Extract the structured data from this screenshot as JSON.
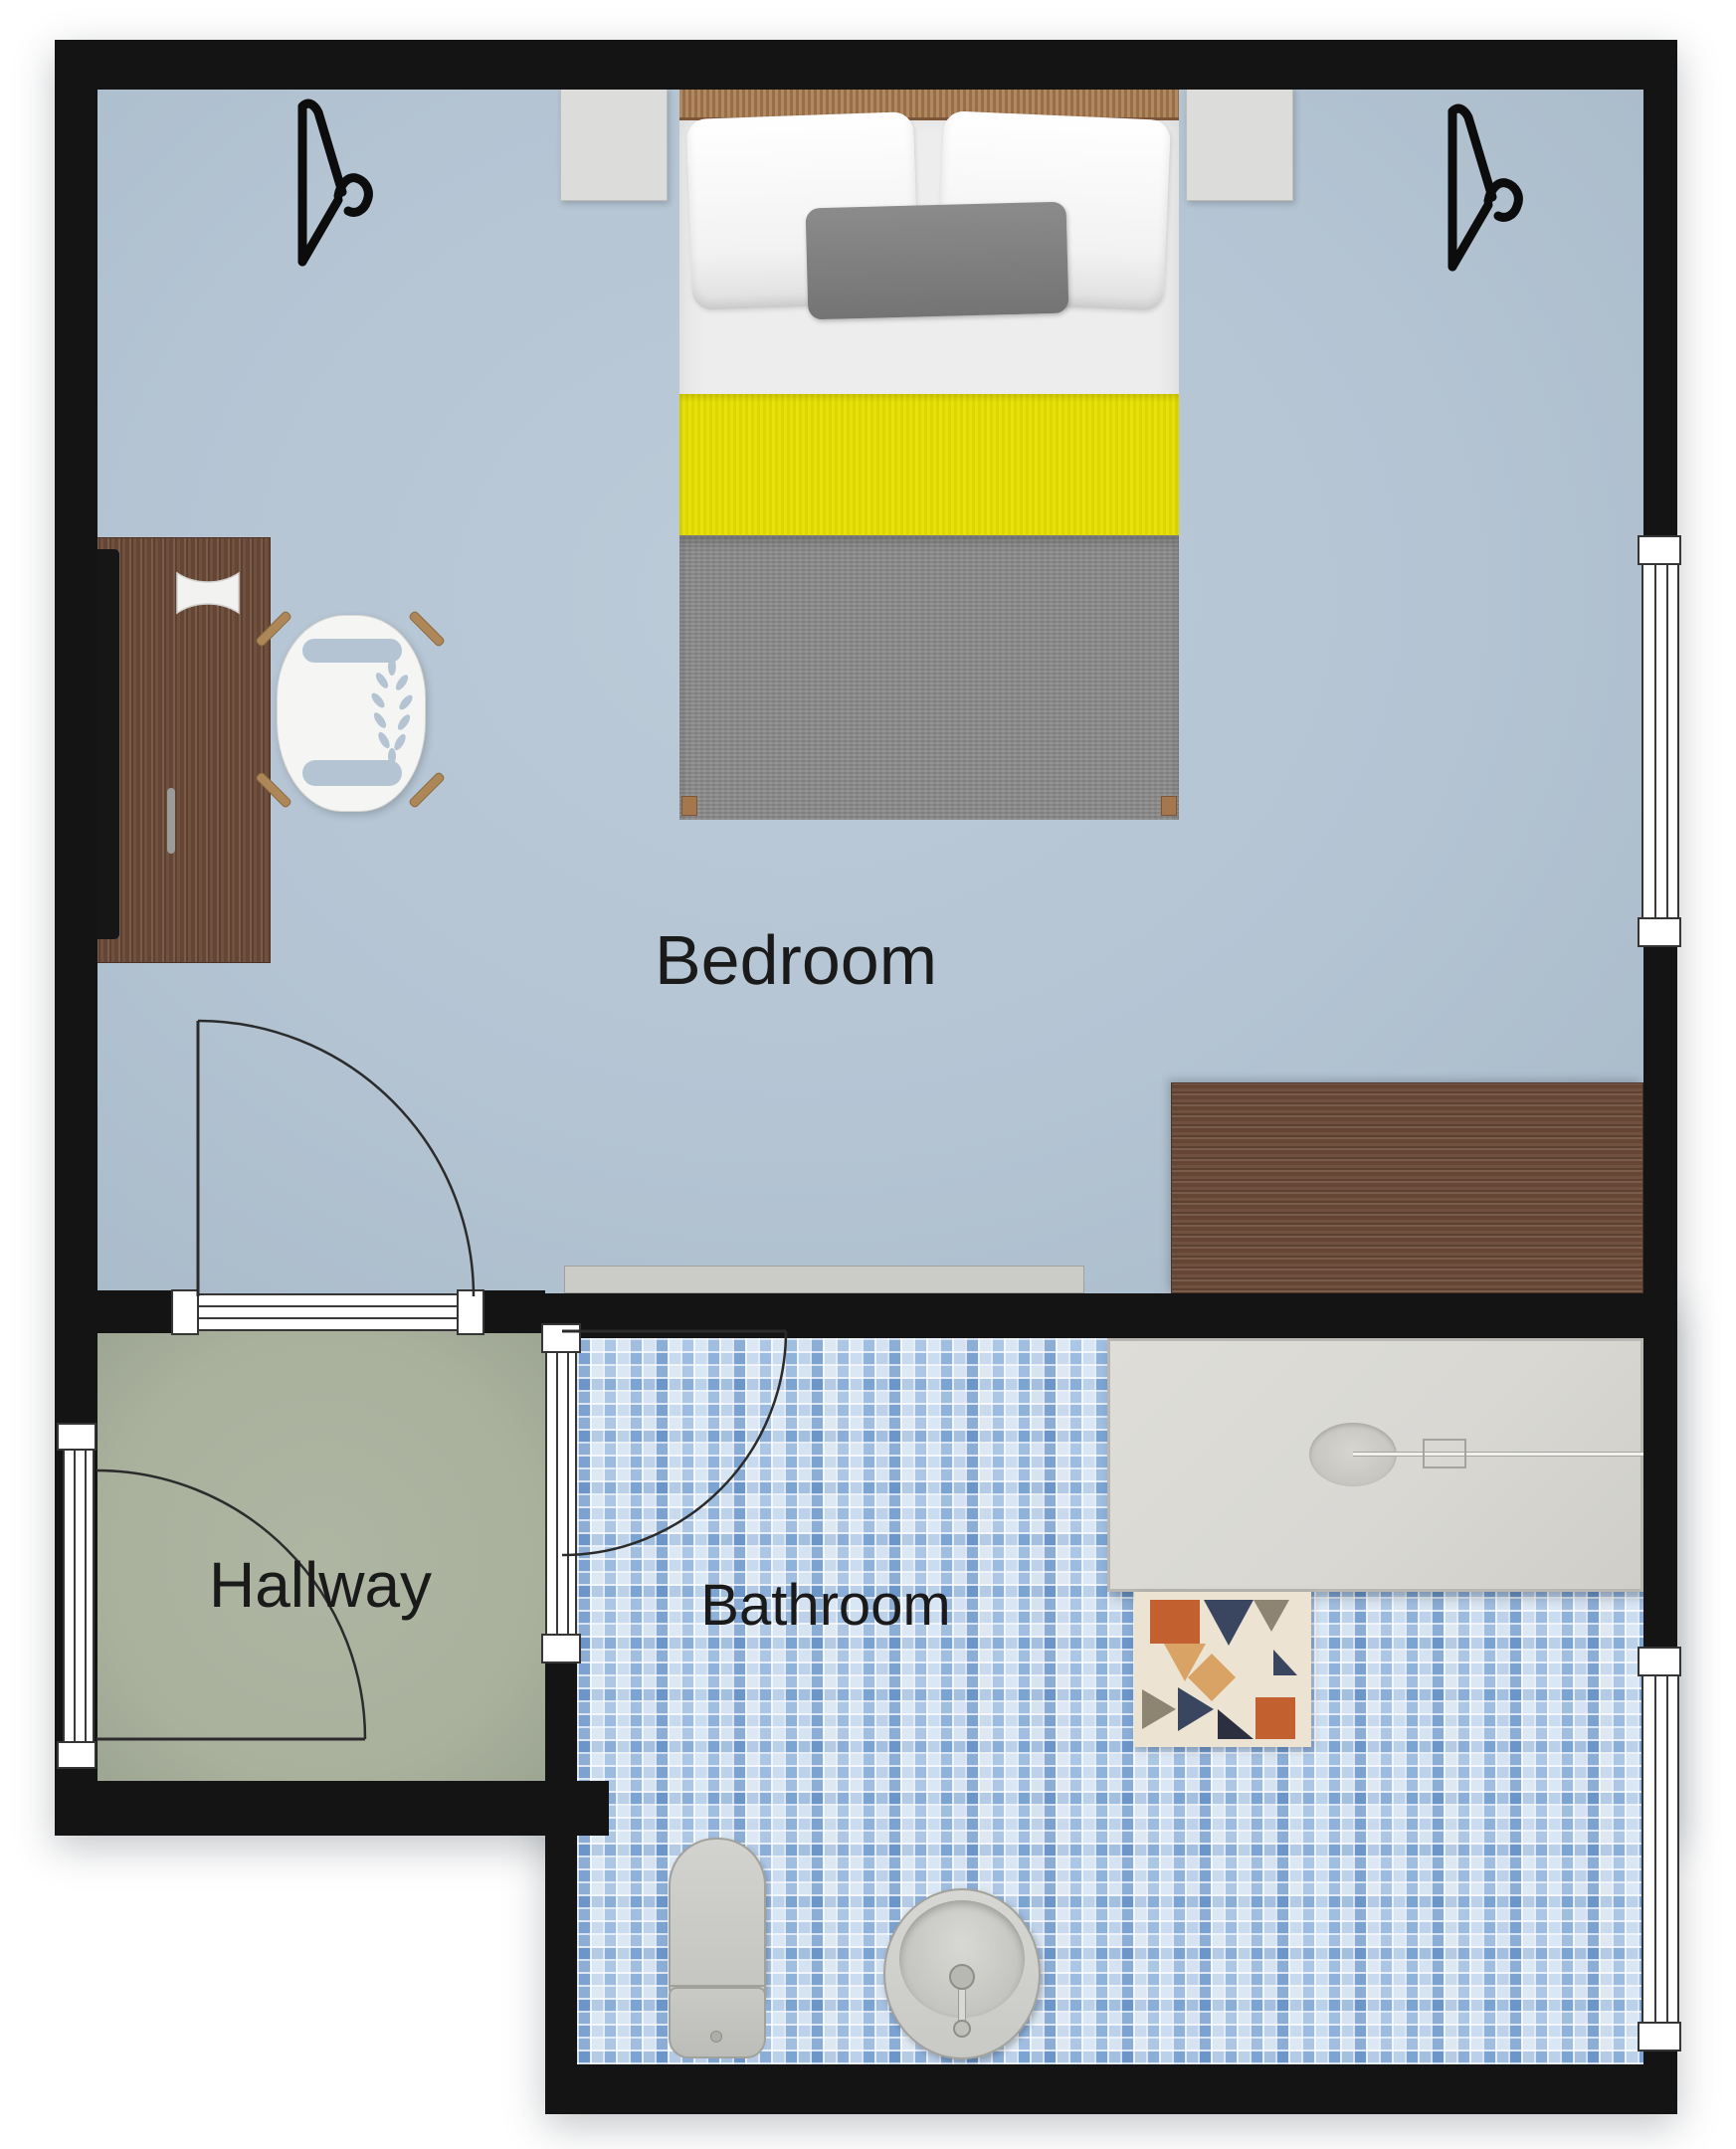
{
  "title": "Apartment floor plan",
  "rooms": [
    {
      "id": "bedroom",
      "label": "Bedroom"
    },
    {
      "id": "hallway",
      "label": "Hallway"
    },
    {
      "id": "bathroom",
      "label": "Bathroom"
    }
  ],
  "colors": {
    "wall": "#141414",
    "bedroom_floor": "#b4c4d3",
    "hallway_floor": "#a9b19d",
    "bathroom_tile_base": "#c3d6ea",
    "bathroom_tile_accent": "#4a7fc1",
    "bed_accent": "#e6df00",
    "bed_blanket": "#8b8b8b",
    "wood_dark": "#6b4a38",
    "wood_light": "#a5774c",
    "shower_tray": "#d9d8d3",
    "fixture_gray": "#c8c8c5",
    "rug_base": "#ece3d3",
    "rug_orange": "#c2602f",
    "rug_navy": "#3a4660",
    "rug_tan": "#d9a365"
  }
}
